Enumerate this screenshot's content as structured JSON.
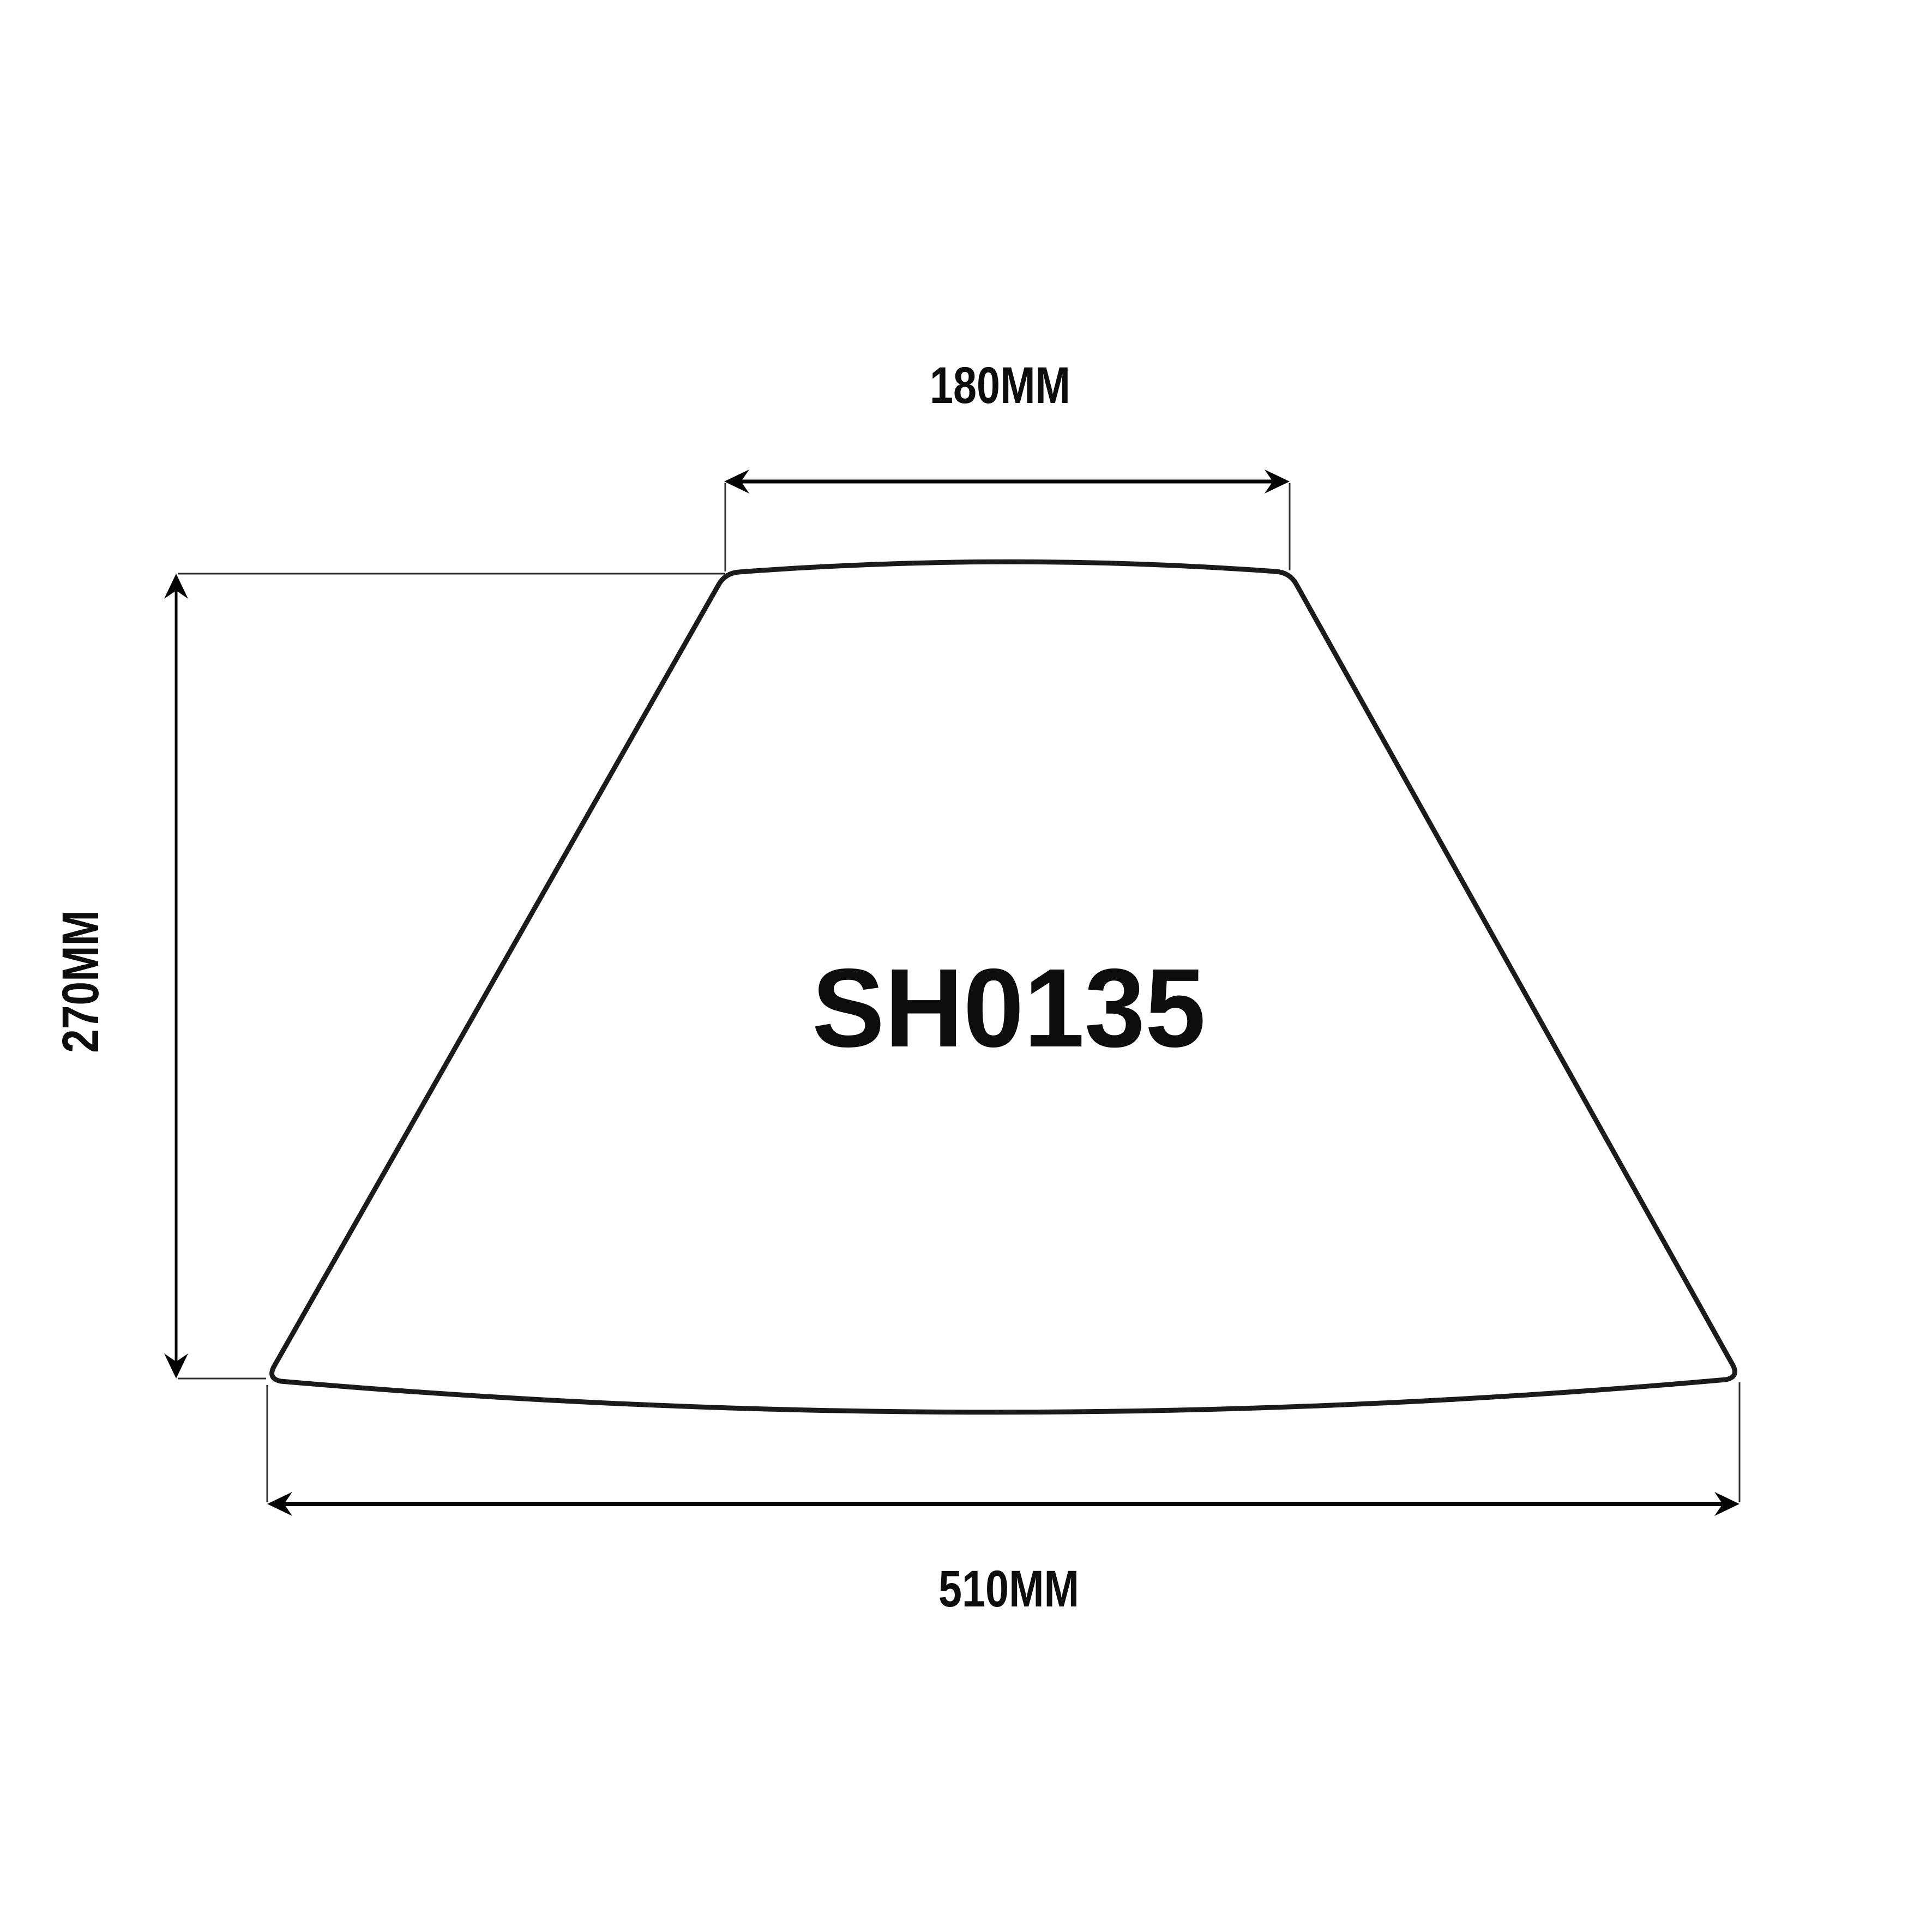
{
  "drawing": {
    "model": "SH0135",
    "dimensions": {
      "top_width": "180MM",
      "height": "270MM",
      "bottom_width": "510MM"
    }
  },
  "colors": {
    "background": "#ffffff",
    "outline": "#1b1b1b",
    "dimension_lines": "#050505",
    "text": "#0d0d0d"
  }
}
